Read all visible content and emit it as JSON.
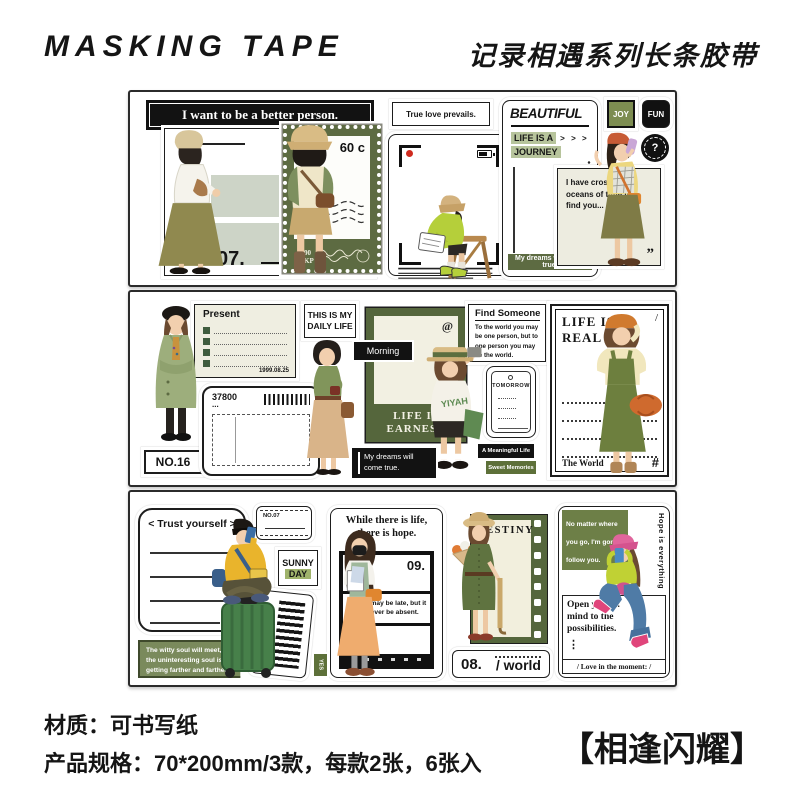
{
  "page": {
    "brand": "MASKING TAPE",
    "series_title": "记录相遇系列长条胶带",
    "material_line": "材质：可书写纸",
    "spec_line": "产品规格：70*200mm/3款，每款2张，6张入",
    "product_name": "【相逢闪耀】"
  },
  "colors": {
    "olive": "#5d6b42",
    "olive_dark": "#55663c",
    "badge_green": "#7d8d51",
    "highlight_green": "#b7c49c",
    "witty_green": "#7a8a5c",
    "lime": "#b5cf3a",
    "cream": "#efeee1",
    "sage_block": "#cdd4c7",
    "black": "#121212"
  },
  "s1": {
    "banner": "I want to be a better person.",
    "caption07": "True happiness comes from belonging...",
    "num07": "07.",
    "stamp_denom": "60 c",
    "stamp_1": "1",
    "stamp_00": "00",
    "stamp_kp": "KP",
    "true_love": "True love prevails.",
    "plus": "+",
    "title": "BEAUTIFUL",
    "life": "LIFE IS A",
    "arrows": ">  >  >",
    "journey": "JOURNEY",
    "badge": "My dreams will come true.",
    "quote": "I have crossed oceans of time to find you...",
    "qmark": "”",
    "joy": "JOY",
    "fun": "FUN",
    "q": "?"
  },
  "s2": {
    "no16": "NO.16",
    "present": "Present",
    "date": "1999.08.25",
    "daily": "THIS IS MY DAILY LIFE",
    "ticket": "37800",
    "tdots": "...",
    "morning": "Morning",
    "at": "@",
    "earnest1": "LIFE IS",
    "earnest2": "EARNEST",
    "yiyah": "YIYAH",
    "dreams": "My dreams will come true.",
    "find_t": "Find Someone",
    "find_b": "To the world you may be one person, but to one person you may be the world.",
    "tomorrow": "TOMORROW",
    "meaningful": "A Meaningful Life",
    "sweet": "Sweet Memories",
    "real1": "LIFE IS",
    "real2": "REAL",
    "slash": "/",
    "world": "The World",
    "hash": "#"
  },
  "s3": {
    "trust": "< Trust yourself >",
    "no07": "NO.07",
    "sunny": "SUNNY",
    "day": "DAY",
    "barcode": "A meaningful life",
    "witty": "The witty soul will meet, and the uninteresting soul is getting farther and farther ...",
    "yes": "YES",
    "hope_t": "While there is life, there is hope.",
    "n09": "09.",
    "hope_b": "Beauty may be late, but it will never be absent.",
    "destiny": "DESTINY",
    "n08": "08.",
    "world": "/ world",
    "follow": "No matter where you go, I'm gonna follow you.",
    "hope_v": "Hope is everything",
    "open": "Open  your  ...  mind to the possibilities.",
    "dots": "⋮",
    "moment": "/ Love in the moment: /"
  }
}
